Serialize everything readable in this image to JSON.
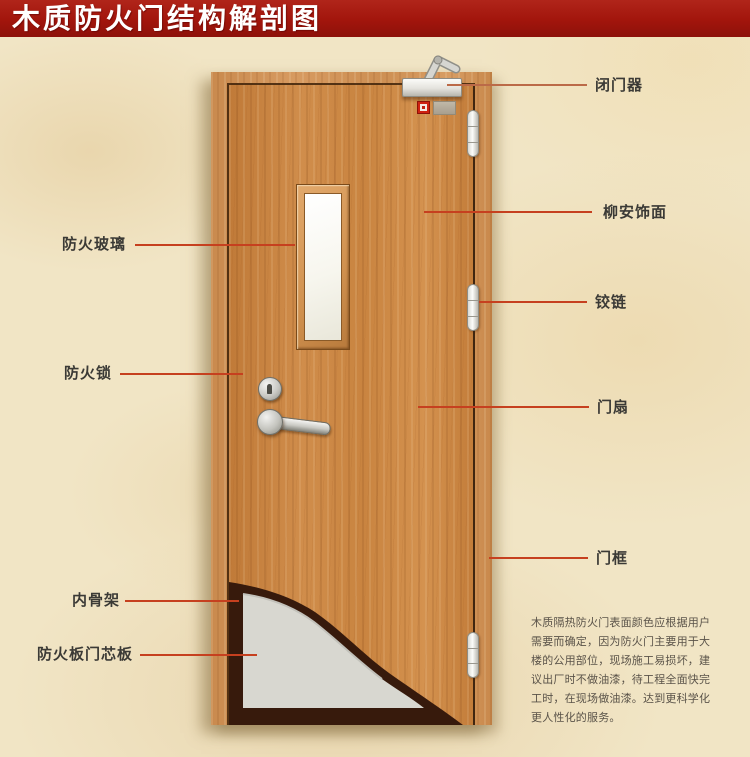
{
  "title": "木质防火门结构解剖图",
  "labels": {
    "right": [
      {
        "id": "door-closer",
        "text": "闭门器"
      },
      {
        "id": "lauan-veneer",
        "text": "柳安饰面"
      },
      {
        "id": "hinge",
        "text": "铰链"
      },
      {
        "id": "door-leaf",
        "text": "门扇"
      },
      {
        "id": "door-frame",
        "text": "门框"
      }
    ],
    "left": [
      {
        "id": "fire-glass",
        "text": "防火玻璃"
      },
      {
        "id": "fire-lock",
        "text": "防火锁"
      },
      {
        "id": "inner-skeleton",
        "text": "内骨架"
      },
      {
        "id": "fire-core-board",
        "text": "防火板门芯板"
      }
    ]
  },
  "description": {
    "lines": [
      "木质隔热防火门表面颜色应根据用户",
      "需要而确定，因为防火门主要用于大",
      "楼的公用部位，现场施工易损坏，建",
      "议出厂时不做油漆，待工程全面快完",
      "工时，在现场做油漆。达到更科学化",
      "更人性化的服务。"
    ]
  },
  "colors": {
    "banner_red": "#a2150c",
    "banner_text": "#ffffff",
    "background_cream": "#f1e5c5",
    "door_wood": "#c9823f",
    "frame_wood": "#d0925a",
    "skeleton_dark": "#3a1c0d",
    "core_board_gray": "#d8d7d0",
    "leader_line_red": "#c6401f",
    "label_text": "#3b3a36",
    "description_text": "#5a5349"
  }
}
